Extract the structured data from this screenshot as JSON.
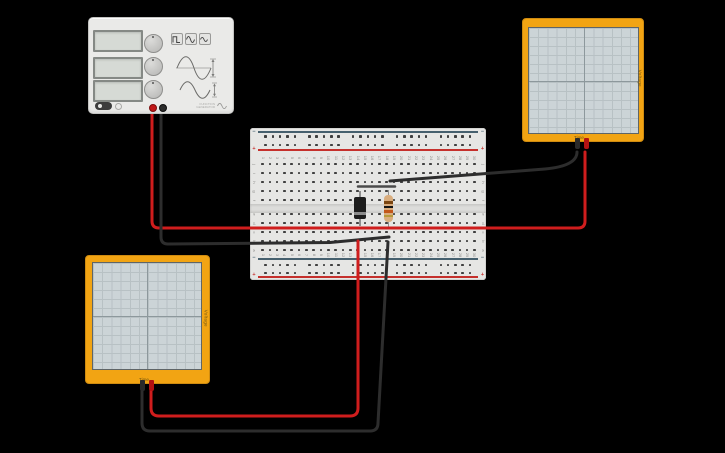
{
  "app": {
    "background_color": "#000000"
  },
  "function_generator": {
    "name": "Function Generator",
    "brand_line1": "FUNCTION",
    "brand_line2": "GENERATOR",
    "wave_buttons": [
      {
        "icon": "square-wave-icon"
      },
      {
        "icon": "sine-wave-icon"
      },
      {
        "icon": "triangle-wave-icon"
      }
    ],
    "terminal_positive_color": "#c11818",
    "terminal_negative_color": "#2c2c2c"
  },
  "breadboard": {
    "column_numbers": [
      "1",
      "2",
      "3",
      "4",
      "5",
      "6",
      "7",
      "8",
      "9",
      "10",
      "11",
      "12",
      "13",
      "14",
      "15",
      "16",
      "17",
      "18",
      "19",
      "20",
      "21",
      "22",
      "23",
      "24",
      "25",
      "26",
      "27",
      "28",
      "29",
      "30"
    ],
    "row_letters_top": [
      "j",
      "i",
      "h",
      "g",
      "f"
    ],
    "row_letters_bottom": [
      "e",
      "d",
      "c",
      "b",
      "a"
    ],
    "positive_sign": "+",
    "negative_sign": "−",
    "positive_rail_color": "#c5302c",
    "negative_rail_color": "#46606e"
  },
  "oscilloscopes": [
    {
      "voltage_label": "Voltage",
      "time_label": "Time"
    },
    {
      "voltage_label": "Voltage",
      "time_label": "Time"
    }
  ],
  "components": {
    "diode": {
      "body_color": "#1d1d1d",
      "stripe_color": "#8c8c8c"
    },
    "resistor": {
      "body_color": "#d9ad7e",
      "band_colors": [
        "#7a4511",
        "#141414",
        "#c2571a",
        "#b89a3a"
      ]
    }
  },
  "wires": [
    {
      "name": "wire-fg-positive",
      "color": "#cf1d1d",
      "width": 3,
      "path": "M152,107 L152,221 Q152,228 159,228 L578,228 Q585,228 585,221 L585,152"
    },
    {
      "name": "wire-fg-negative",
      "color": "#2d2d2d",
      "width": 3,
      "path": "M161,107 L161,237 Q161,244 168,244 L330,242.5 L389,237"
    },
    {
      "name": "wire-scope1-negative",
      "color": "#2d2d2d",
      "width": 3,
      "path": "M390,181 L545,169 Q577,166 577,152"
    },
    {
      "name": "wire-scope2-positive",
      "color": "#cf1d1d",
      "width": 3,
      "path": "M151,386 L151,408 Q151,416 159,416 L350,416 Q358,416 358,408 L358,241"
    },
    {
      "name": "wire-scope2-negative",
      "color": "#2d2d2d",
      "width": 3,
      "path": "M142,386 L142,423 Q142,431 150,431 L370,431 Q378,431 378,423 L388,242"
    },
    {
      "name": "wire-breadboard-jumper",
      "color": "#4b4b4b",
      "width": 2.5,
      "path": "M358,186.5 L395,186.5"
    }
  ]
}
